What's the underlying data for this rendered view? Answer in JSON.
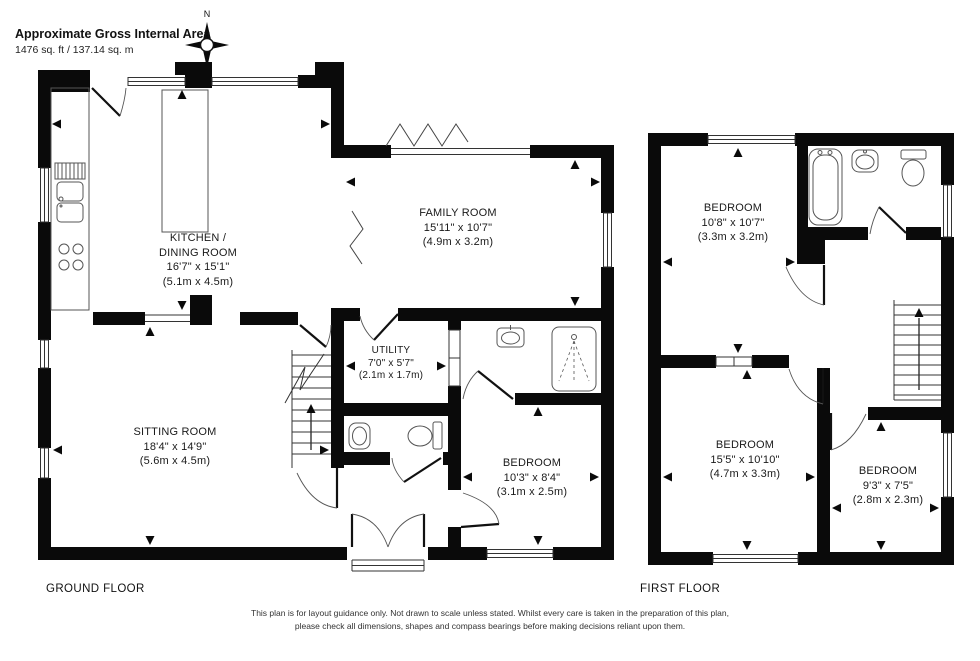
{
  "header": {
    "title": "Approximate Gross Internal Area",
    "area": "1476 sq. ft / 137.14 sq. m"
  },
  "compass": {
    "north": "N"
  },
  "ground_floor": {
    "label": "GROUND FLOOR",
    "rooms": {
      "kitchen_dining": {
        "line1": "KITCHEN /",
        "line2": "DINING ROOM",
        "imperial": "16'7\" x 15'1\"",
        "metric": "(5.1m x 4.5m)"
      },
      "family": {
        "name": "FAMILY ROOM",
        "imperial": "15'11\" x 10'7\"",
        "metric": "(4.9m x 3.2m)"
      },
      "utility": {
        "name": "UTILITY",
        "imperial": "7'0\" x 5'7\"",
        "metric": "(2.1m x 1.7m)"
      },
      "sitting": {
        "name": "SITTING ROOM",
        "imperial": "18'4\" x 14'9\"",
        "metric": "(5.6m x 4.5m)"
      },
      "bedroom": {
        "name": "BEDROOM",
        "imperial": "10'3\" x 8'4\"",
        "metric": "(3.1m x 2.5m)"
      }
    }
  },
  "first_floor": {
    "label": "FIRST FLOOR",
    "rooms": {
      "bedroom1": {
        "name": "BEDROOM",
        "imperial": "10'8\" x 10'7\"",
        "metric": "(3.3m x 3.2m)"
      },
      "bedroom2": {
        "name": "BEDROOM",
        "imperial": "15'5\" x 10'10\"",
        "metric": "(4.7m x 3.3m)"
      },
      "bedroom3": {
        "name": "BEDROOM",
        "imperial": "9'3\" x 7'5\"",
        "metric": "(2.8m x 2.3m)"
      }
    }
  },
  "footer": {
    "line1": "This plan is for layout guidance only.  Not drawn to scale unless stated. Whilst every care is taken in the preparation of this plan,",
    "line2": "please check all dimensions, shapes and compass bearings before making decisions reliant upon them."
  }
}
